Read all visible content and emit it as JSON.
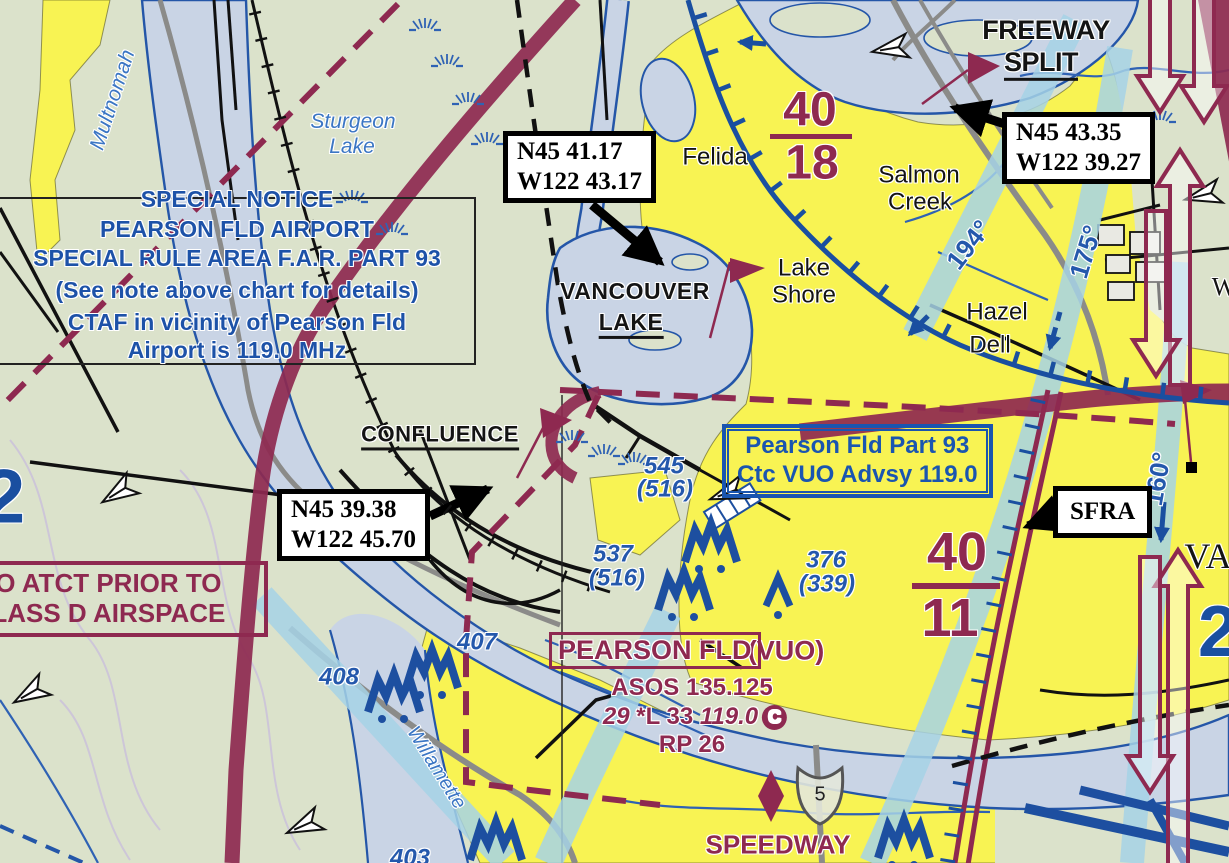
{
  "colors": {
    "land": "#dbe2cb",
    "water": "#c9d4e5",
    "urban_yellow": "#f8f353",
    "aero_blue": "#1a4fa0",
    "chart_maroon": "#8e2950",
    "corridor_blue": "#a6d2e6",
    "hydro_blue": "#3b76c4"
  },
  "notice": {
    "lines": [
      "SPECIAL NOTICE",
      "PEARSON FLD AIRPORT",
      "SPECIAL RULE AREA F.A.R. PART 93",
      "(See note above chart for details)",
      "CTAF in vicinity of Pearson Fld",
      "Airport is 119.0 MHz"
    ]
  },
  "callouts": {
    "vancouver_lake": {
      "line1": "N45 41.17",
      "line2": "W122 43.17"
    },
    "freeway_split": {
      "line1": "N45 43.35",
      "line2": "W122 39.27"
    },
    "confluence": {
      "line1": "N45 39.38",
      "line2": "W122 45.70"
    },
    "sfra": {
      "label": "SFRA"
    }
  },
  "boxes": {
    "part93": {
      "line1": "Pearson Fld Part 93",
      "line2": "Ctc VUO Advsy 119.0"
    },
    "no_atct": {
      "line1": "NO ATCT PRIOR TO",
      "line2": "CLASS D AIRSPACE"
    }
  },
  "airport": {
    "name": "PEARSON FLD",
    "ident": "(VUO)",
    "asos": "ASOS 135.125",
    "elev": "29",
    "lighting": "*L",
    "length": "33",
    "ctaf": "119.0",
    "ctaf_circle": "C",
    "rp": "RP 26"
  },
  "places": {
    "freeway": "FREEWAY",
    "split": "SPLIT",
    "felida": "Felida",
    "salmon": "Salmon",
    "creek": "Creek",
    "lake": "Lake",
    "shore": "Shore",
    "hazel": "Hazel",
    "dell": "Dell",
    "vancouver": "VANCOUVER",
    "vanlake": "LAKE",
    "confluence": "CONFLUENCE",
    "speedway": "SPEEDWAY",
    "va_partial": "VA",
    "w_partial": "W"
  },
  "hydro": {
    "multnomah": "Multnomah",
    "sturgeon1": "Sturgeon",
    "sturgeon2": "Lake",
    "willamette": "Willamette"
  },
  "mef": {
    "nw": {
      "num": "40",
      "den": "18"
    },
    "se": {
      "num": "40",
      "den": "11"
    }
  },
  "bearings": {
    "b194": "194°",
    "b175": "175°",
    "b160": "160°"
  },
  "obstacles": {
    "o545": "545",
    "o545agl": "(516)",
    "o537": "537",
    "o537agl": "(516)",
    "o376": "376",
    "o376agl": "(339)",
    "o407": "407",
    "o408": "408",
    "o403": "403"
  },
  "partials": {
    "left2": "2",
    "right2": "2"
  },
  "shield": {
    "num": "5"
  }
}
